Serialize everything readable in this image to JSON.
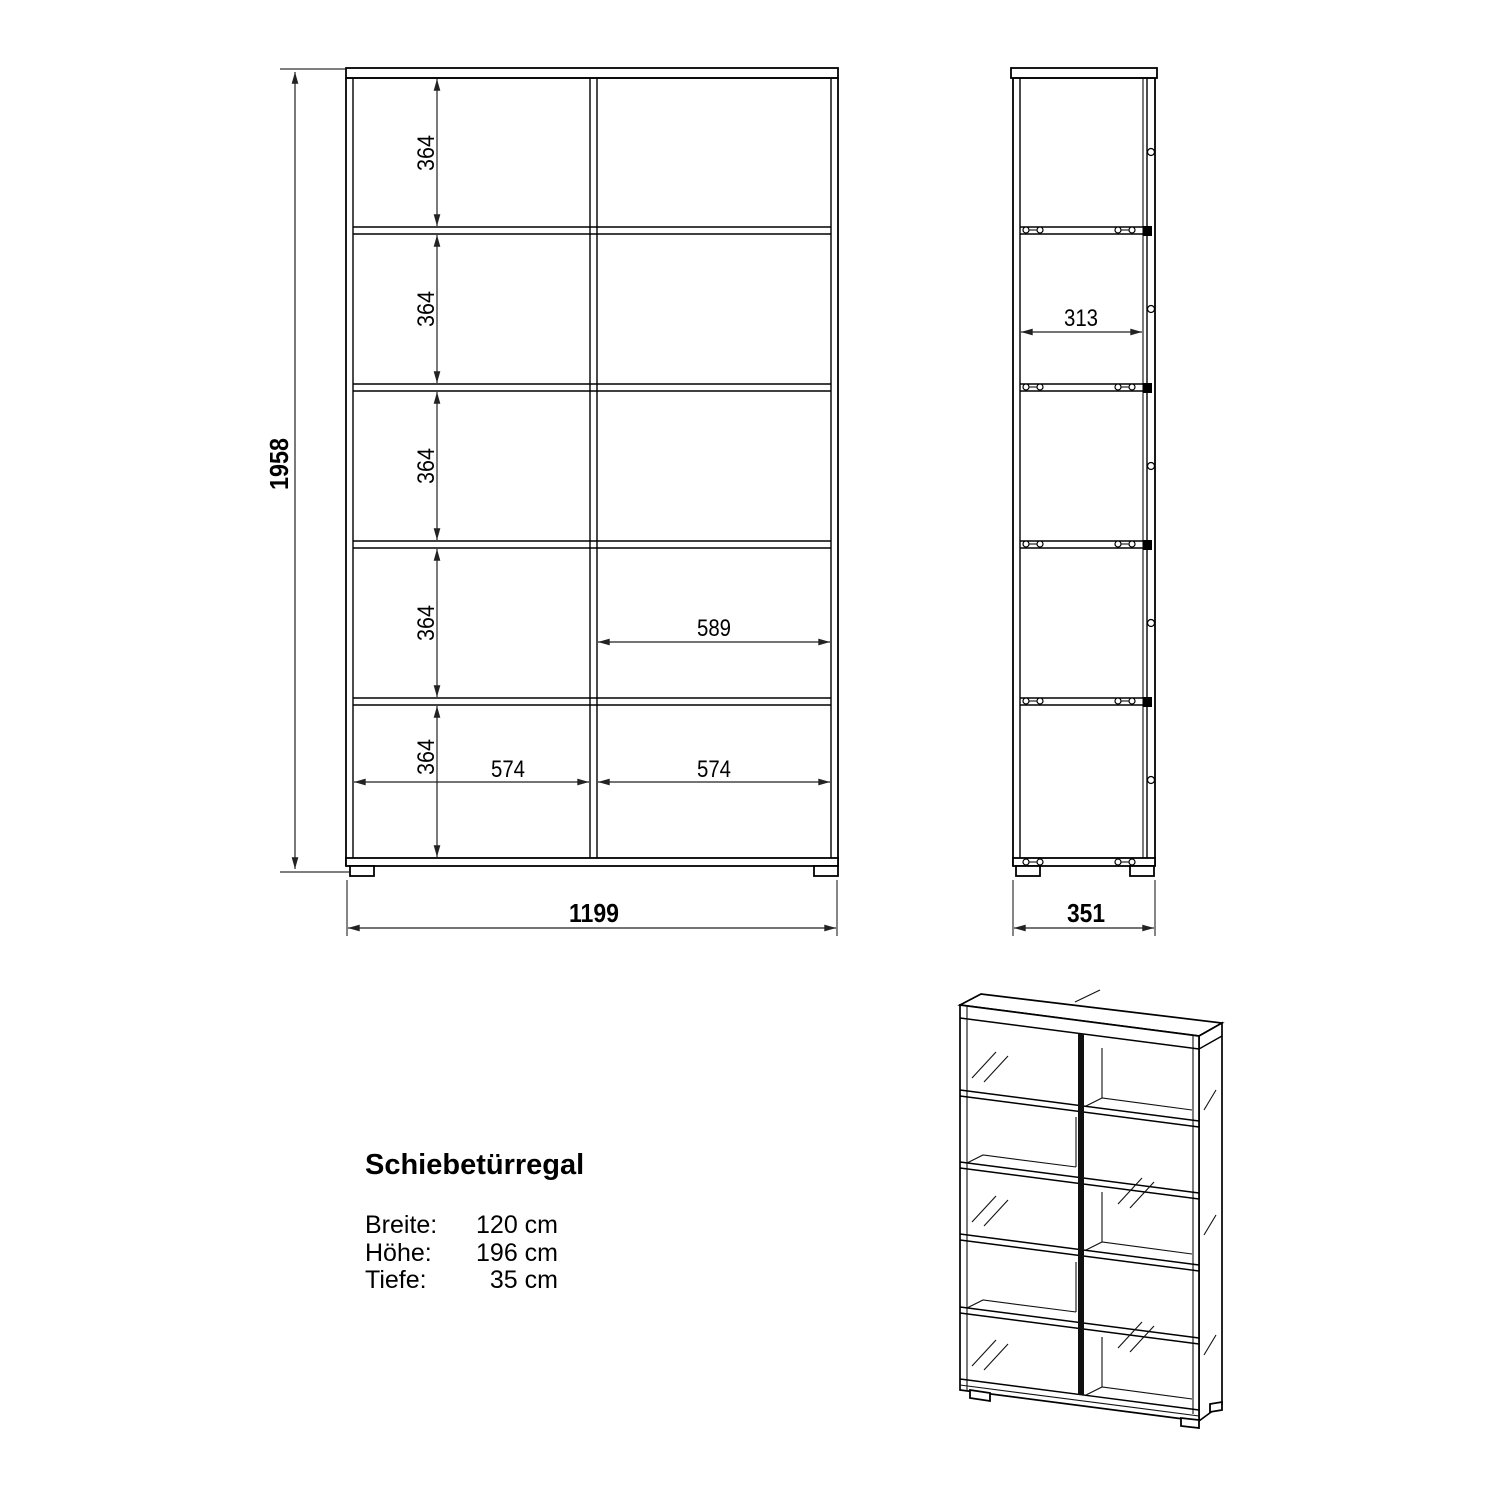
{
  "drawing": {
    "title": "Schiebetürregal",
    "specs": [
      {
        "label": "Breite:",
        "value": "120 cm"
      },
      {
        "label": "Höhe:",
        "value": "196 cm"
      },
      {
        "label": "Tiefe:",
        "value": "35 cm"
      }
    ],
    "front_view": {
      "overall_height": "1958",
      "overall_width": "1199",
      "shelf_heights": [
        "364",
        "364",
        "364",
        "364",
        "364"
      ],
      "sliding_door_width": "589",
      "compartment_widths": [
        "574",
        "574"
      ]
    },
    "side_view": {
      "inner_depth": "313",
      "overall_depth": "351"
    }
  }
}
